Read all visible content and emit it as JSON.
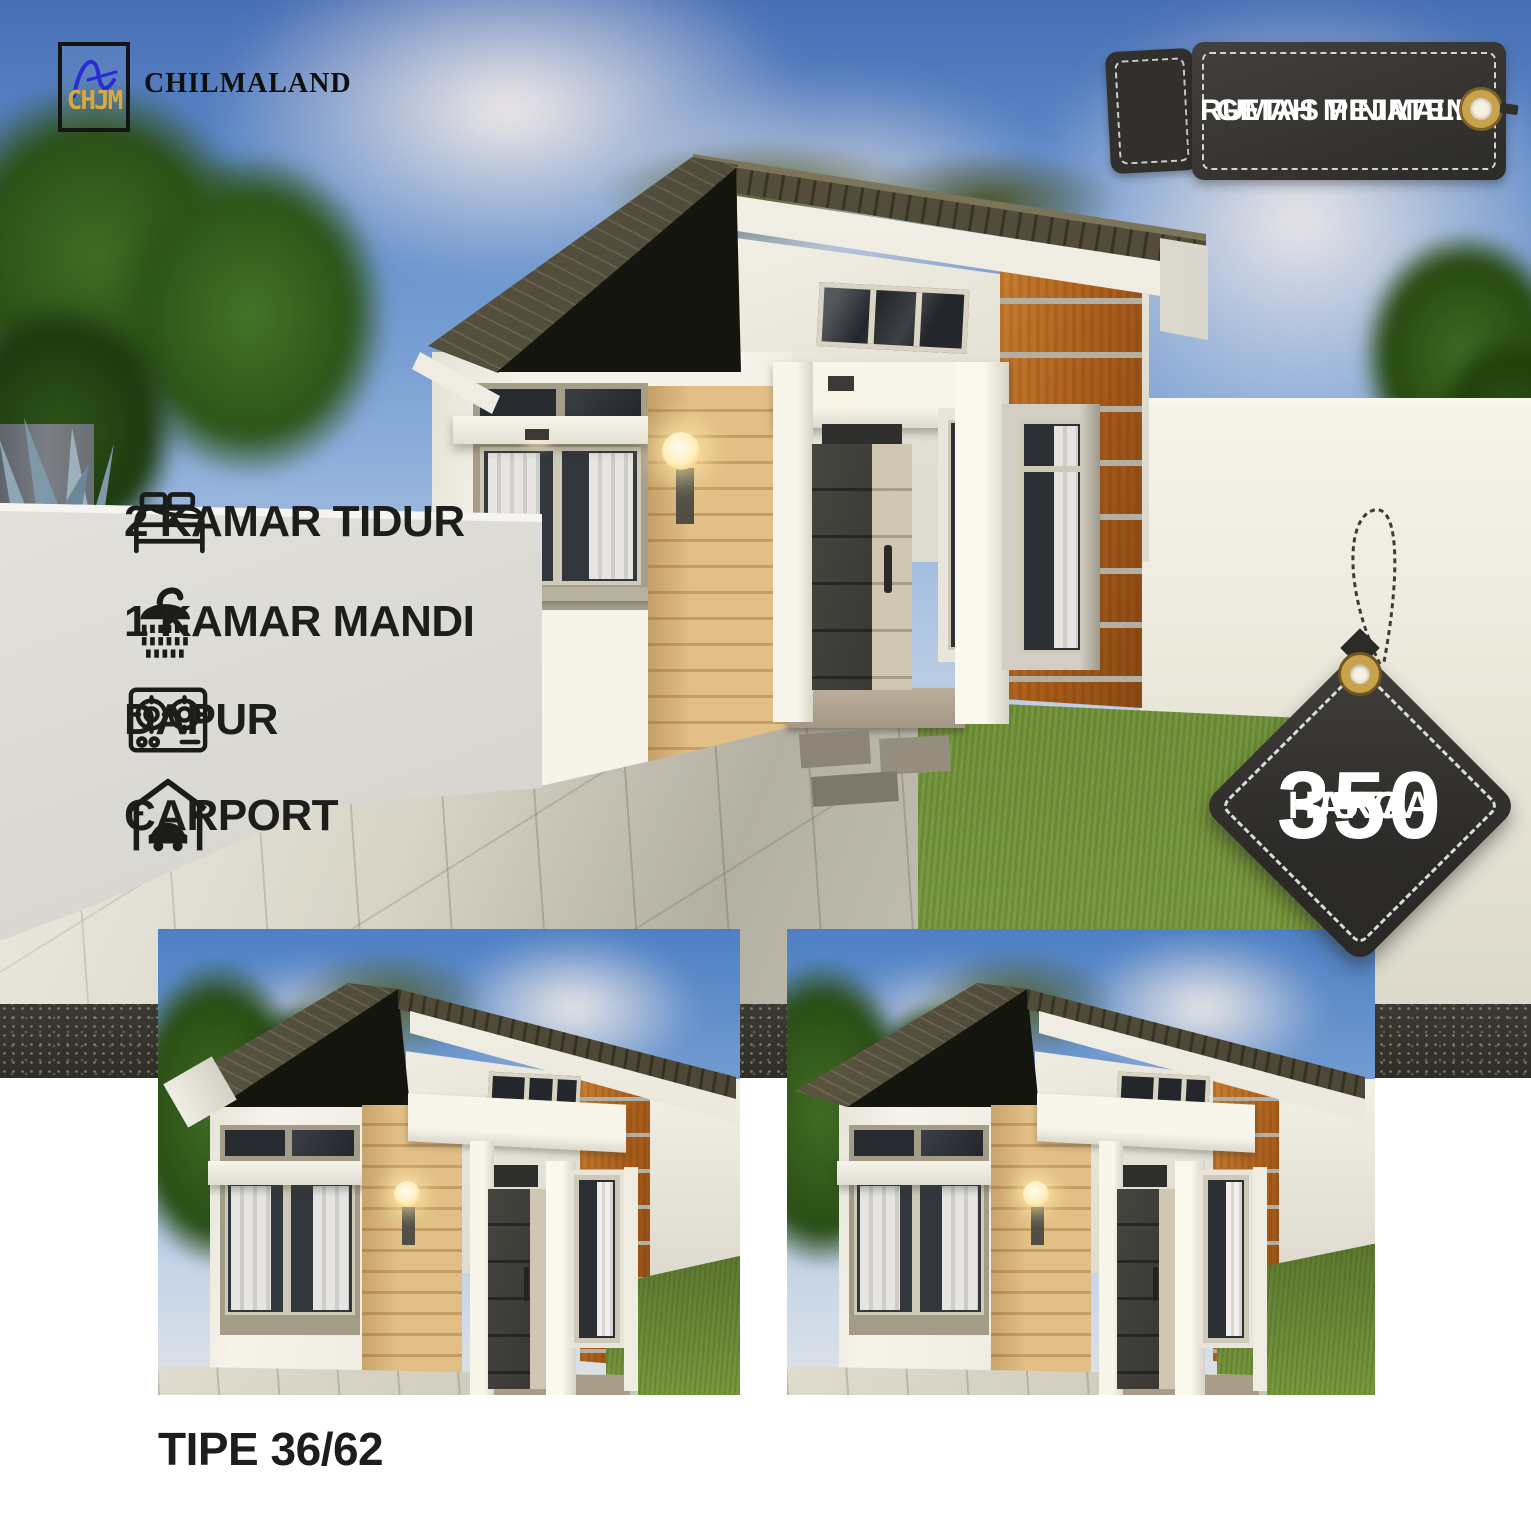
{
  "brand": {
    "name": "CHILMALAND",
    "monogram_bottom": "CHJM"
  },
  "location_tag": {
    "line1": "RUMAH MINIMALIS",
    "line2": "GETAS PEJATEN"
  },
  "features": [
    {
      "icon": "bed-icon",
      "label": "2 KAMAR TIDUR"
    },
    {
      "icon": "shower-icon",
      "label": "1 KAMAR MANDI"
    },
    {
      "icon": "stove-icon",
      "label": "DAPUR"
    },
    {
      "icon": "carport-icon",
      "label": "CARPORT"
    }
  ],
  "price_tag": {
    "heading": "HARGA",
    "amount": "350",
    "unit": "JUTA"
  },
  "type_label": "TIPE 36/62",
  "colors": {
    "tag_dark": "#34322f",
    "gold_grommet": "#c9a34b",
    "text_dark": "#1d1d1b",
    "roof_olive": "#4c4735",
    "wood_tan": "#dcb67c",
    "wood_orange": "#ab5d1b",
    "grass_green": "#6f8f39",
    "sky_blue": "#4e80c4"
  }
}
